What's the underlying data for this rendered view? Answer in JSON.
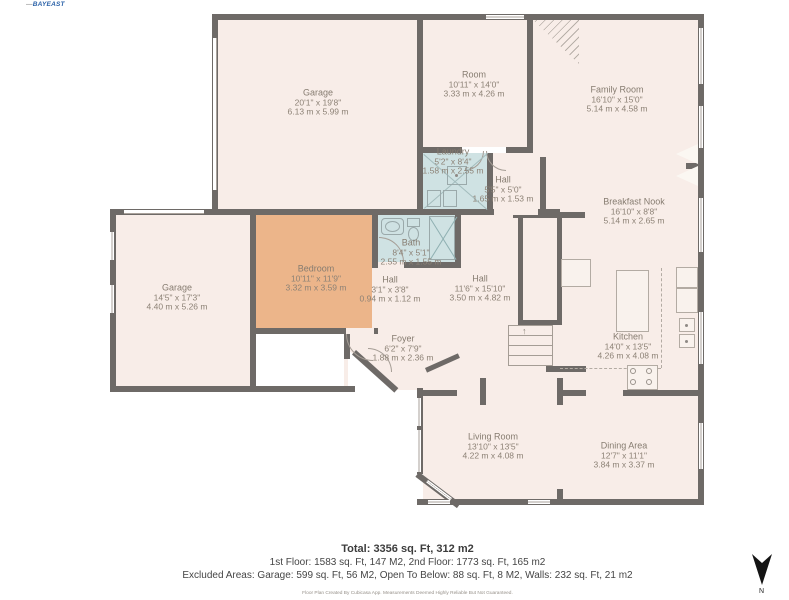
{
  "logo": {
    "text": "BAYEAST"
  },
  "compass": {
    "label": "N"
  },
  "rooms": [
    {
      "name": "Garage",
      "imperial": "20'1\" x 19'8\"",
      "metric": "6.13 m x 5.99 m"
    },
    {
      "name": "Room",
      "imperial": "10'11\" x 14'0\"",
      "metric": "3.33 m x 4.26 m"
    },
    {
      "name": "Family Room",
      "imperial": "16'10\" x 15'0\"",
      "metric": "5.14 m x 4.58 m"
    },
    {
      "name": "Laundry",
      "imperial": "5'2\" x 8'4\"",
      "metric": "1.58 m x 2.55 m"
    },
    {
      "name": "Hall",
      "imperial": "5'5\" x 5'0\"",
      "metric": "1.65 m x 1.53 m"
    },
    {
      "name": "Breakfast Nook",
      "imperial": "16'10\" x 8'8\"",
      "metric": "5.14 m x 2.65 m"
    },
    {
      "name": "Garage",
      "imperial": "14'5\" x 17'3\"",
      "metric": "4.40 m x 5.26 m"
    },
    {
      "name": "Bedroom",
      "imperial": "10'11\" x 11'9\"",
      "metric": "3.32 m x 3.59 m"
    },
    {
      "name": "Bath",
      "imperial": "8'4\" x 5'1\"",
      "metric": "2.55 m x 1.55 m"
    },
    {
      "name": "Hall",
      "imperial": "3'1\" x 3'8\"",
      "metric": "0.94 m x 1.12 m"
    },
    {
      "name": "Hall",
      "imperial": "11'6\" x 15'10\"",
      "metric": "3.50 m x 4.82 m"
    },
    {
      "name": "Foyer",
      "imperial": "6'2\" x 7'9\"",
      "metric": "1.88 m x 2.36 m"
    },
    {
      "name": "Kitchen",
      "imperial": "14'0\" x 13'5\"",
      "metric": "4.26 m x 4.08 m"
    },
    {
      "name": "Living Room",
      "imperial": "13'10\" x 13'5\"",
      "metric": "4.22 m x 4.08 m"
    },
    {
      "name": "Dining Area",
      "imperial": "12'7\" x 11'1\"",
      "metric": "3.84 m x 3.37 m"
    }
  ],
  "footer": {
    "total": "Total: 3356 sq. Ft, 312 m2",
    "floors": "1st Floor: 1583 sq. Ft, 147 M2, 2nd Floor: 1773 sq. Ft, 165 m2",
    "excluded": "Excluded Areas: Garage: 599 sq. Ft, 56 M2, Open To Below: 88 sq. Ft, 8 M2, Walls: 232 sq. Ft, 21 m2",
    "disclaimer": "Floor Plan Created By Cubicasa App. Measurements Deemed Highly Reliable But Not Guaranteed."
  },
  "colors": {
    "floor": "#f8ede8",
    "wet": "#cfe2e3",
    "bedroom": "#ecb58a",
    "wall": "#6e6a67"
  }
}
